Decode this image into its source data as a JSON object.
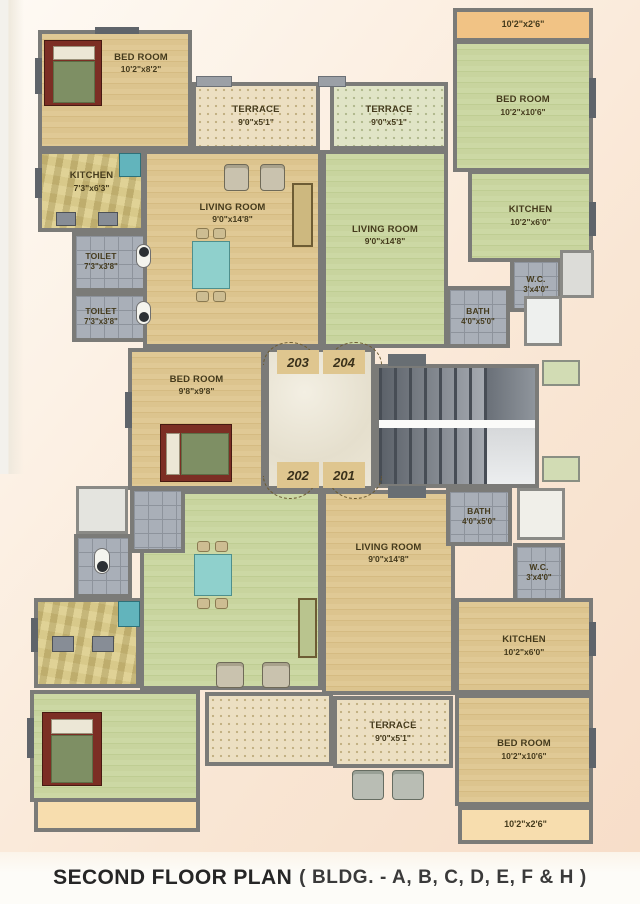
{
  "title": {
    "main": "SECOND FLOOR PLAN",
    "suffix": "( BLDG. - A, B, C, D, E, F & H )"
  },
  "units": {
    "tl": "203",
    "tr": "204",
    "bl": "202",
    "br": "201"
  },
  "rooms": {
    "tl_bed1": {
      "name": "BED ROOM",
      "dim": "10'2\"x8'2\""
    },
    "tl_kitchen": {
      "name": "KITCHEN",
      "dim": "7'3\"x6'3\""
    },
    "tl_toilet_a": {
      "name": "TOILET",
      "dim": "7'3\"x3'8\""
    },
    "tl_toilet_b": {
      "name": "TOILET",
      "dim": "7'3\"x3'8\""
    },
    "tl_terrace": {
      "name": "TERRACE",
      "dim": "9'0\"x5'1\""
    },
    "tl_living": {
      "name": "LIVING ROOM",
      "dim": "9'0\"x14'8\""
    },
    "tl_bed2": {
      "name": "BED ROOM",
      "dim": "9'8\"x9'8\""
    },
    "tr_balcony": {
      "dim": "10'2\"x2'6\""
    },
    "tr_bed": {
      "name": "BED ROOM",
      "dim": "10'2\"x10'6\""
    },
    "tr_kitchen": {
      "name": "KITCHEN",
      "dim": "10'2\"x6'0\""
    },
    "tr_wc": {
      "name": "W.C.",
      "dim": "3'x4'0\""
    },
    "tr_bath": {
      "name": "BATH",
      "dim": "4'0\"x5'0\""
    },
    "tr_terrace": {
      "name": "TERRACE",
      "dim": "9'0\"x5'1\""
    },
    "tr_living": {
      "name": "LIVING ROOM",
      "dim": "9'0\"x14'8\""
    },
    "br_living": {
      "name": "LIVING ROOM",
      "dim": "9'0\"x14'8\""
    },
    "br_bath": {
      "name": "BATH",
      "dim": "4'0\"x5'0\""
    },
    "br_wc": {
      "name": "W.C.",
      "dim": "3'x4'0\""
    },
    "br_kitchen": {
      "name": "KITCHEN",
      "dim": "10'2\"x6'0\""
    },
    "br_terrace": {
      "name": "TERRACE",
      "dim": "9'0\"x5'1\""
    },
    "br_bed": {
      "name": "BED ROOM",
      "dim": "10'2\"x10'6\""
    },
    "br_balcony": {
      "dim": "10'2\"x2'6\""
    }
  },
  "colors": {
    "wall": "#7b7b78",
    "wood_floor": "#dcc48e",
    "green_floor": "#c8d49e",
    "terrace_tile": "#ecdfc2",
    "terrace_tile_green": "#e0e4c6",
    "bathroom_tile": "#a9afb8",
    "balcony": "#f1c385",
    "balcony_pale": "#f7ddae",
    "lobby_marble": "#eae4d4",
    "background": "#f9e6d4",
    "label_text": "#443a1c"
  }
}
